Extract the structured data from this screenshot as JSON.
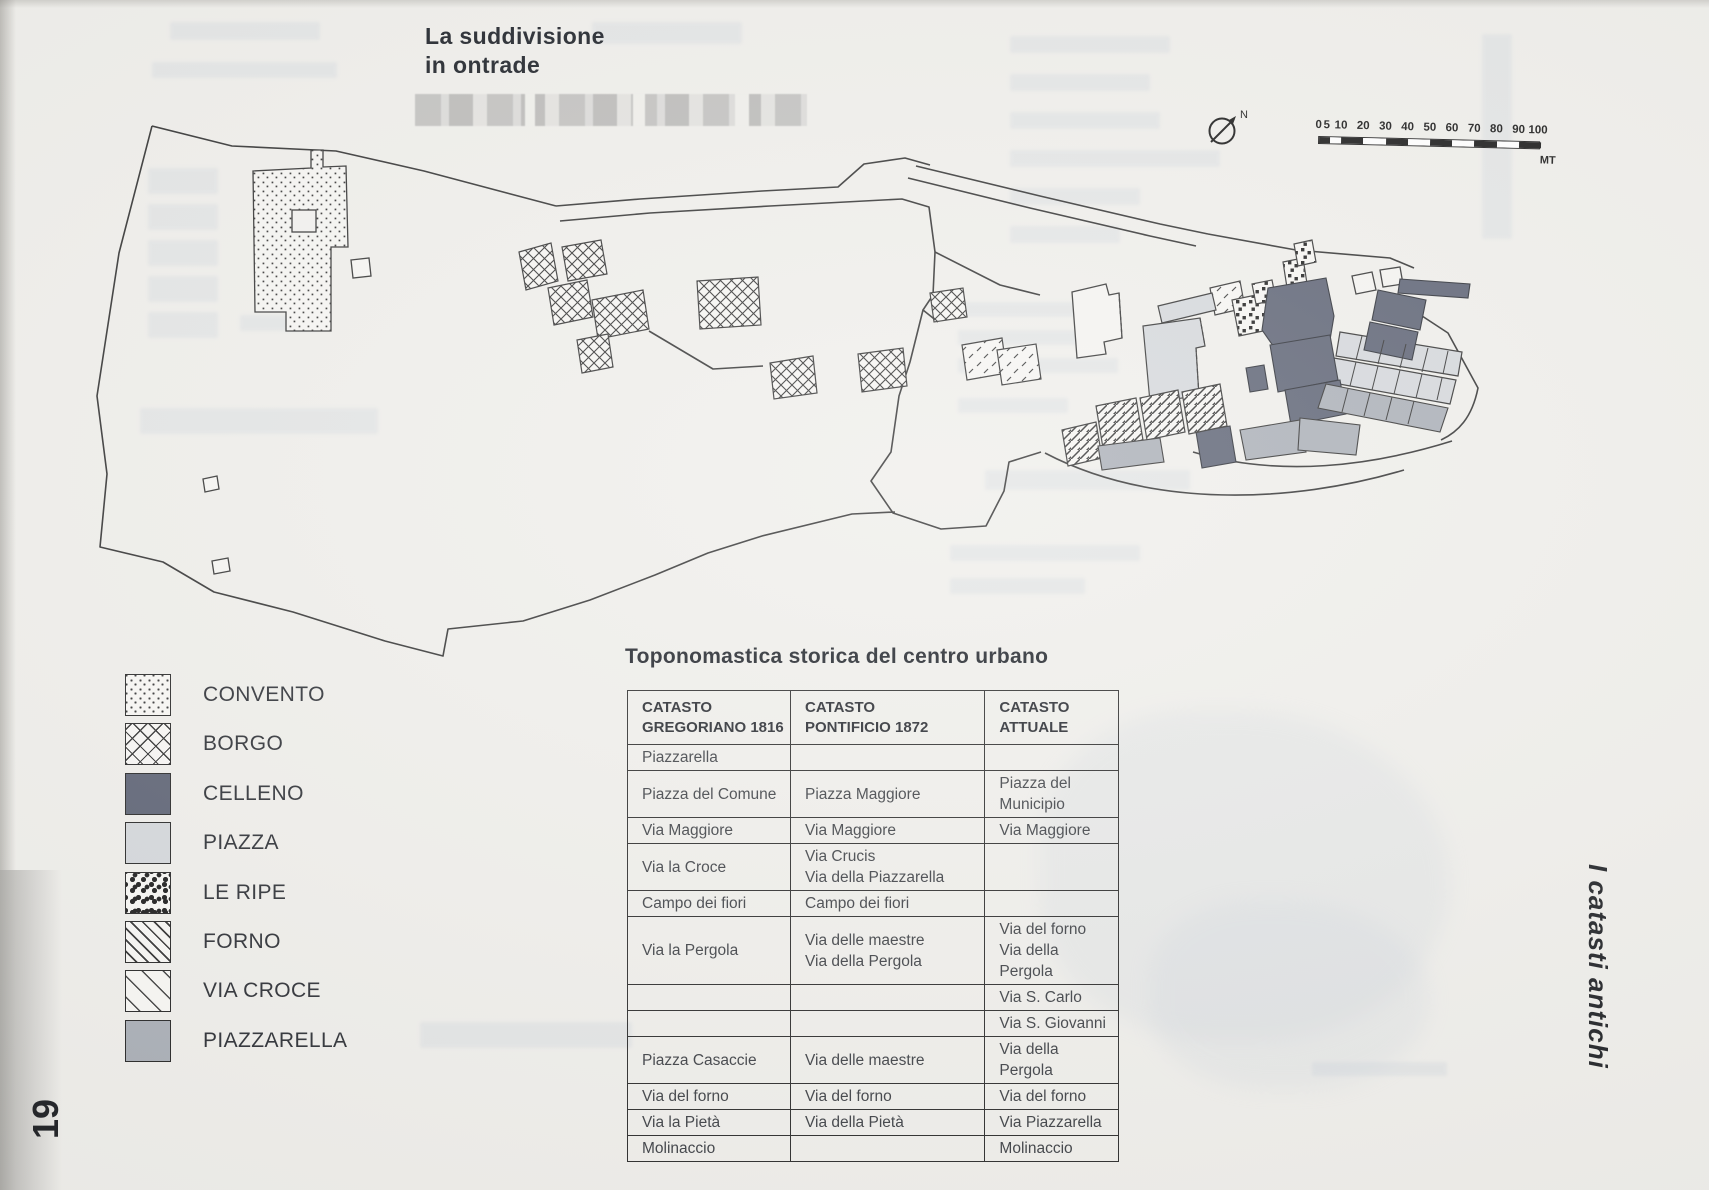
{
  "page": {
    "number": "19",
    "side_label": "I catasti antichi"
  },
  "map": {
    "title_line1": "La suddivisione",
    "title_line2": "in ontrade",
    "compass_label": "N",
    "scale": {
      "ticks": [
        0,
        5,
        10,
        20,
        30,
        40,
        50,
        60,
        70,
        80,
        90,
        100
      ],
      "unit": "MT"
    }
  },
  "legend": {
    "items": [
      {
        "label": "CONVENTO",
        "pattern": "dots",
        "swatch_class": "swatch pat-dots"
      },
      {
        "label": "BORGO",
        "pattern": "crosshatch",
        "swatch_class": "swatch pat-cross"
      },
      {
        "label": "CELLENO",
        "pattern": "solid-dark",
        "swatch_class": "swatch sw-dark"
      },
      {
        "label": "PIAZZA",
        "pattern": "solid-light",
        "swatch_class": "swatch sw-light"
      },
      {
        "label": "LE RIPE",
        "pattern": "black-squares",
        "swatch_class": "swatch pat-squares"
      },
      {
        "label": "FORNO",
        "pattern": "diagonal-hatch",
        "swatch_class": "swatch pat-diag"
      },
      {
        "label": "VIA CROCE",
        "pattern": "sparse-diagonal",
        "swatch_class": "swatch pat-sparse"
      },
      {
        "label": "PIAZZARELLA",
        "pattern": "solid-medium",
        "swatch_class": "swatch sw-medium"
      }
    ]
  },
  "table": {
    "title": "Toponomastica storica del centro urbano",
    "columns": [
      "CATASTO\nGREGORIANO 1816",
      "CATASTO\nPONTIFICIO 1872",
      "CATASTO\nATTUALE"
    ],
    "rows": [
      [
        "Piazzarella",
        "",
        ""
      ],
      [
        "Piazza del Comune",
        "Piazza Maggiore",
        "Piazza del Municipio"
      ],
      [
        "Via Maggiore",
        "Via Maggiore",
        "Via Maggiore"
      ],
      [
        "Via la Croce",
        "Via Crucis\nVia della Piazzarella",
        ""
      ],
      [
        "Campo dei fiori",
        "Campo dei fiori",
        ""
      ],
      [
        "Via la Pergola",
        "Via delle maestre\nVia della Pergola",
        "Via del forno\nVia della Pergola"
      ],
      [
        "",
        "",
        "Via S. Carlo"
      ],
      [
        "",
        "",
        "Via S. Giovanni"
      ],
      [
        "Piazza Casaccie",
        "Via delle maestre",
        "Via della Pergola"
      ],
      [
        "Via del forno",
        "Via del forno",
        "Via del forno"
      ],
      [
        "Via la Pietà",
        "Via della Pietà",
        "Via Piazzarella"
      ],
      [
        "Molinaccio",
        "",
        "Molinaccio"
      ]
    ]
  },
  "theme": {
    "colors": {
      "paper": "#efeeea",
      "ink": "#1d2127",
      "dark": "#575d6f",
      "light": "#d3d6da",
      "medium": "#a7acb4",
      "ghost": "#c7cfd9"
    }
  }
}
